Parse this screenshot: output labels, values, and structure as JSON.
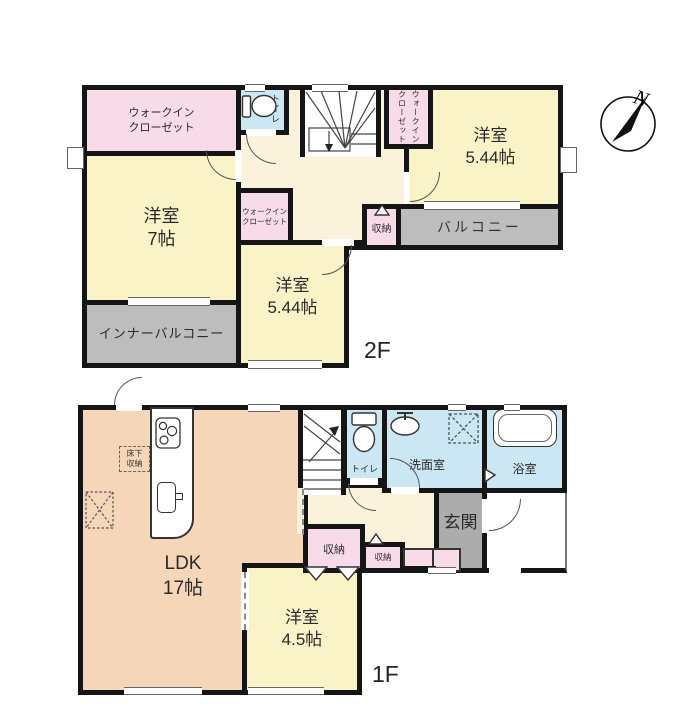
{
  "compass": {
    "north": "N"
  },
  "floor2": {
    "label": "2F",
    "walk_in_closet_nw": {
      "line1": "ウォークイン",
      "line2": "クローゼット"
    },
    "western_room_7": {
      "name": "洋室",
      "size": "7帖"
    },
    "inner_balcony": {
      "label": "インナーバルコニー"
    },
    "toilet": {
      "label": "トイレ"
    },
    "walk_in_closet_mid": {
      "line1": "ウォークイン",
      "line2": "クローゼット"
    },
    "walk_in_closet_ne": {
      "line1": "ウォークイン",
      "line2": "クローゼット"
    },
    "western_room_ne": {
      "name": "洋室",
      "size": "5.44帖"
    },
    "western_room_s": {
      "name": "洋室",
      "size": "5.44帖"
    },
    "balcony": {
      "label": "バルコニー"
    },
    "storage": {
      "label": "収納"
    }
  },
  "floor1": {
    "label": "1F",
    "ldk": {
      "name": "LDK",
      "size": "17帖"
    },
    "underfloor_storage": {
      "line1": "床下",
      "line2": "収納"
    },
    "toilet": {
      "label": "トイレ"
    },
    "washroom": {
      "label": "洗面室"
    },
    "bathroom": {
      "label": "浴室"
    },
    "entrance": {
      "label": "玄関"
    },
    "storage_hall": {
      "label": "収納"
    },
    "storage_small": {
      "label": "収納"
    },
    "western_room_45": {
      "name": "洋室",
      "size": "4.5帖"
    }
  },
  "colors": {
    "room_yellow": "#FAF3C8",
    "closet_pink": "#F8DBE8",
    "wet_area_blue": "#CBE7F3",
    "ldk_peach": "#F5D6B8",
    "hall_cream": "#FBF2DB",
    "balcony_gray": "#BDBDBD",
    "entrance_gray": "#ACACAC",
    "wall_black": "#151515"
  }
}
